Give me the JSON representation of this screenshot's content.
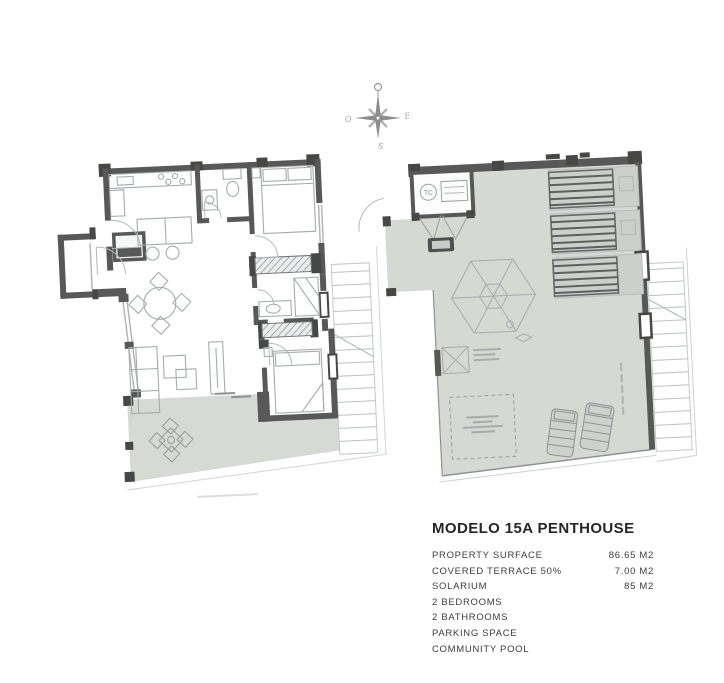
{
  "info_panel": {
    "title": "MODELO 15A PENTHOUSE",
    "specs": [
      {
        "label": "PROPERTY SURFACE",
        "value": "86.65 M2"
      },
      {
        "label": "COVERED TERRACE 50%",
        "value": "7.00 M2"
      },
      {
        "label": "SOLARIUM",
        "value": "85 M2"
      },
      {
        "label": "2 BEDROOMS",
        "value": ""
      },
      {
        "label": "2 BATHROOMS",
        "value": ""
      },
      {
        "label": "PARKING SPACE",
        "value": ""
      },
      {
        "label": "COMMUNITY POOL",
        "value": ""
      }
    ]
  },
  "plans": {
    "solarium": {
      "tc_label": "TC"
    }
  },
  "compass": {
    "west": "O",
    "east": "E",
    "south": "S"
  },
  "colors": {
    "wall": "#585858",
    "wall_dark": "#474746",
    "terrace_fill": "#d7d9d5",
    "furniture_line": "#a6abab",
    "light_line": "#c5c8c8",
    "title_text": "#262626",
    "spec_text": "#3c3c3c"
  }
}
